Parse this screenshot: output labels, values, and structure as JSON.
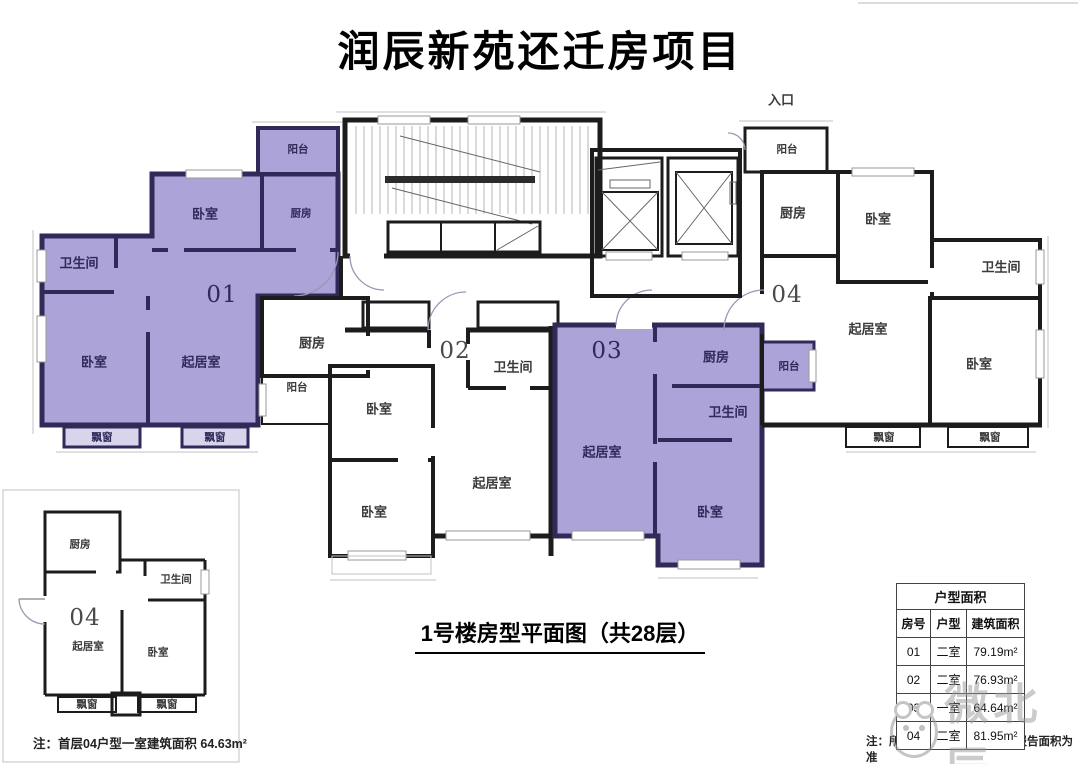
{
  "title": "润辰新苑还迁房项目",
  "entrance_label": "入口",
  "section_label": "1号楼房型平面图（共28层）",
  "watermark": "微北辰",
  "colors": {
    "unit_fill": "#aca3d8",
    "unit_wall": "#2f2a58",
    "wall": "#1c1c1c"
  },
  "plan": {
    "units": {
      "u01": {
        "num": "01",
        "balcony": "阳台",
        "bedroom1": "卧室",
        "kitchen": "厨房",
        "bathroom": "卫生间",
        "bedroom2": "卧室",
        "living": "起居室",
        "bay": "飘窗"
      },
      "u02": {
        "num": "02",
        "kitchen": "厨房",
        "balcony": "阳台",
        "bathroom": "卫生间",
        "bedroom1": "卧室",
        "bedroom2": "卧室",
        "living": "起居室"
      },
      "u03": {
        "num": "03",
        "kitchen": "厨房",
        "balcony": "阳台",
        "bathroom": "卫生间",
        "living": "起居室",
        "bedroom": "卧室"
      },
      "u04": {
        "num": "04",
        "balcony": "阳台",
        "kitchen": "厨房",
        "bedroom1": "卧室",
        "bathroom": "卫生间",
        "living": "起居室",
        "bedroom2": "卧室",
        "bay": "飘窗"
      }
    }
  },
  "mini_plan": {
    "num": "04",
    "kitchen": "厨房",
    "bathroom": "卫生间",
    "living": "起居室",
    "bedroom": "卧室",
    "bay": "飘窗",
    "note": "注：首层04户型一室建筑面积 64.63m²"
  },
  "table": {
    "title": "户型面积",
    "columns": [
      "房号",
      "户型",
      "建筑面积"
    ],
    "rows": [
      {
        "no": "01",
        "type": "二室",
        "area": "79.19m²"
      },
      {
        "no": "02",
        "type": "二室",
        "area": "76.93m²"
      },
      {
        "no": "03",
        "type": "一室",
        "area": "64.64m²"
      },
      {
        "no": "04",
        "type": "二室",
        "area": "81.95m²"
      }
    ]
  },
  "right_note": "注：所有户型面积以登记测绘报告面积为准"
}
